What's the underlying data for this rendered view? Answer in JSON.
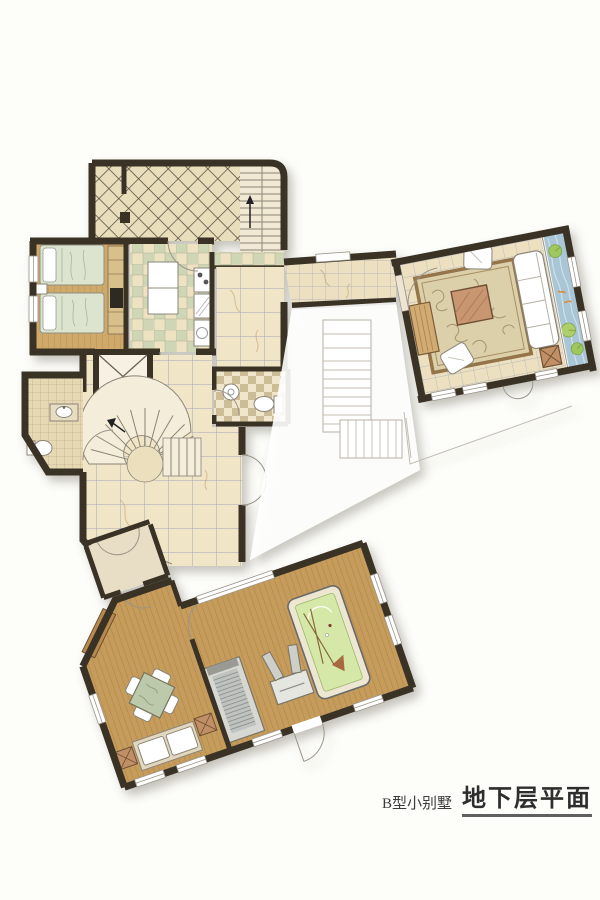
{
  "title": {
    "prefix": "B型小别墅",
    "main": "地下层平面"
  },
  "palette": {
    "paper": "#fdfdfa",
    "wall": "#3a3328",
    "wood_floor": "#c69c5c",
    "wood_light": "#cfa96a",
    "marble_big": "#f0e5c6",
    "marble_small": "#ece0c0",
    "checker_green": "#cfd6b6",
    "checker_cream": "#ede3c3",
    "diamond_tile": "#e9debc",
    "small_tile": "#e7d8b4",
    "stair": "#f3edda",
    "rug": "#dcd0ab",
    "rug_border": "#93744a",
    "water": "#a9c6d6",
    "lily": "#9ec75f",
    "billiard_felt": "#d6e8a8",
    "bedding": "#dce4cf",
    "table_wood": "#c08f66"
  },
  "icons": {
    "stair_up_arrow": "up-arrow",
    "elevator_cross": "x-mark"
  }
}
